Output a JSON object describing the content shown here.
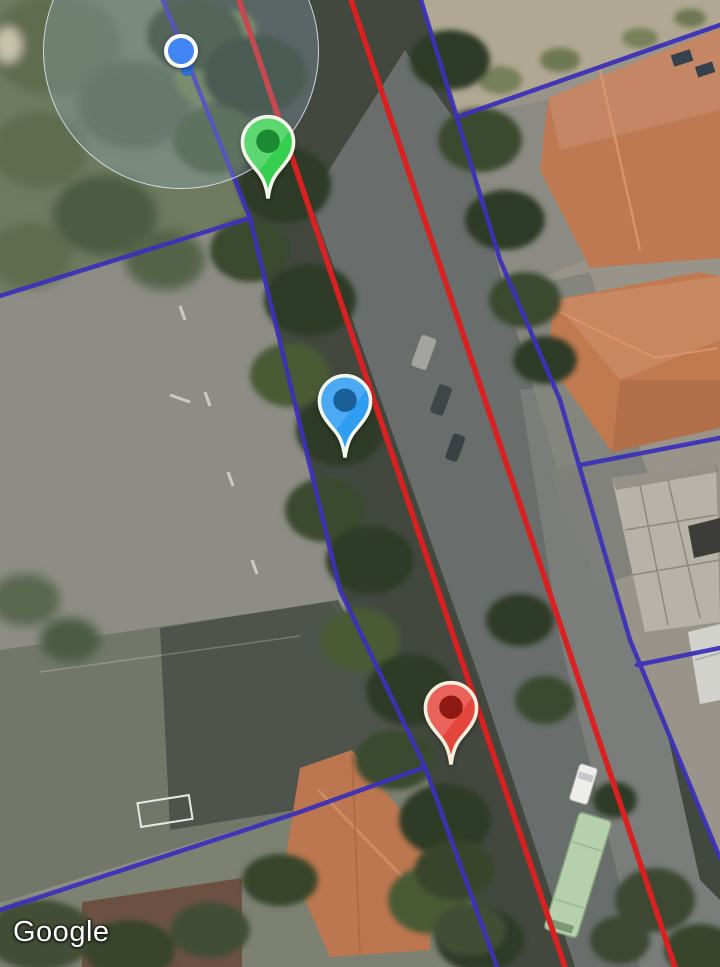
{
  "attribution": {
    "logo_text": "Google"
  },
  "map": {
    "type": "satellite",
    "colors": {
      "route_line": "#d92121",
      "parcel_line": "#3d31b8",
      "location_dot": "#4285f4",
      "accuracy_fill": "rgba(150,178,206,0.28)"
    },
    "location_indicator": {
      "x": 181,
      "y": 51,
      "accuracy_radius": 137,
      "secondary_dot": {
        "x": 187,
        "y": 68
      }
    },
    "markers": [
      {
        "name": "green-pin",
        "x": 268,
        "y": 200,
        "body": "#35ce4d",
        "dot": "#1b8a33",
        "outline": "#f2f7e9"
      },
      {
        "name": "blue-pin",
        "x": 345,
        "y": 459,
        "body": "#2e9df2",
        "dot": "#1a6098",
        "outline": "#f4f6f0"
      },
      {
        "name": "red-pin",
        "x": 451,
        "y": 766,
        "body": "#e5463c",
        "dot": "#8f1a13",
        "outline": "#f7efdc"
      }
    ],
    "route_lines": [
      {
        "name": "route-line-west",
        "points": "239,0 565,967"
      },
      {
        "name": "route-line-east",
        "points": "351,0 675,967"
      }
    ],
    "parcel_lines": [
      {
        "name": "street-left-boundary",
        "points": "163,0 250,218 340,590 425,767 497,967"
      },
      {
        "name": "northwest-branch",
        "points": "250,218 0,296"
      },
      {
        "name": "field-south-boundary",
        "points": "425,767 300,812 0,910"
      },
      {
        "name": "street-right-boundary",
        "points": "421,0 500,260 560,400 630,640 720,858"
      },
      {
        "name": "northeast-branch",
        "points": "460,116 720,25"
      },
      {
        "name": "east-parcel-divider-1",
        "points": "580,465 720,438"
      },
      {
        "name": "east-parcel-divider-2",
        "points": "637,665 720,648"
      }
    ]
  }
}
